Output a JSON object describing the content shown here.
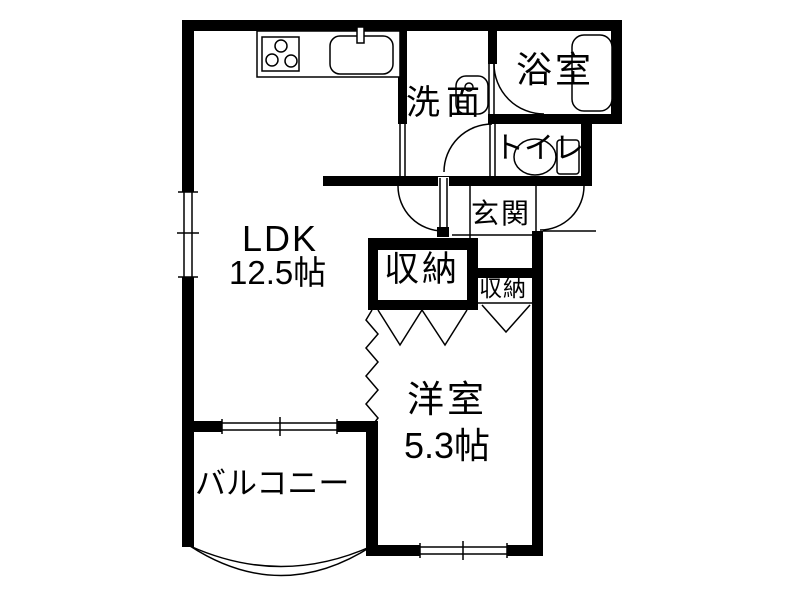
{
  "title": "apartment-floor-plan",
  "rooms": {
    "ldk": {
      "label": "LDK",
      "size": "12.5帖"
    },
    "western_room": {
      "label": "洋室",
      "size": "5.3帖"
    },
    "balcony": {
      "label": "バルコニー"
    },
    "washroom": {
      "label": "洗面"
    },
    "bathroom": {
      "label": "浴室"
    },
    "toilet": {
      "label": "トイレ"
    },
    "entrance": {
      "label": "玄関"
    },
    "closet_large": {
      "label": "収納"
    },
    "closet_small": {
      "label": "収納"
    }
  },
  "fixtures": {
    "stove": "stove-icon",
    "sink": "kitchen-sink-icon",
    "faucet": "faucet-icon",
    "washbasin": "washbasin-icon",
    "bathtub": "bathtub-icon",
    "toilet": "toilet-icon"
  },
  "colors": {
    "wall": "#000000",
    "line": "#1a1a1a",
    "background": "#ffffff"
  }
}
